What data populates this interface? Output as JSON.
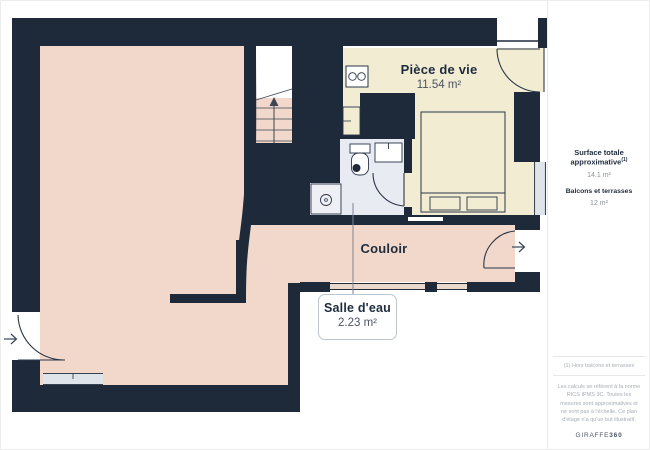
{
  "plan": {
    "rooms": {
      "piece_de_vie": {
        "name": "Pièce de vie",
        "area": "11.54 m²"
      },
      "couloir": {
        "name": "Couloir"
      },
      "salle_deau": {
        "name": "Salle d'eau",
        "area": "2.23 m²"
      }
    }
  },
  "sidebar": {
    "surface_label": "Surface totale approximative",
    "surface_footnote_marker": "(1)",
    "surface_value": "14.1 m²",
    "balconies_label": "Balcons et terrasses",
    "balconies_value": "12 m²",
    "footnote": "(1) Hors balcons et terrasses",
    "disclaimer": "Les calculs se réfèrent à la norme RICS IPMS 3C. Toutes les mesures sont approximatives et ne sont pas à l'échelle. Ce plan d'étage n'a qu'un but illustratif.",
    "logo_prefix": "GIRAFFE",
    "logo_suffix": "360"
  },
  "colors": {
    "wall": "#1e2a3a",
    "living_floor": "#f2d8ca",
    "main_room_floor": "#f2ecd3",
    "bathroom_floor": "#e9ebf2",
    "window_glass": "#dfe4ea"
  }
}
